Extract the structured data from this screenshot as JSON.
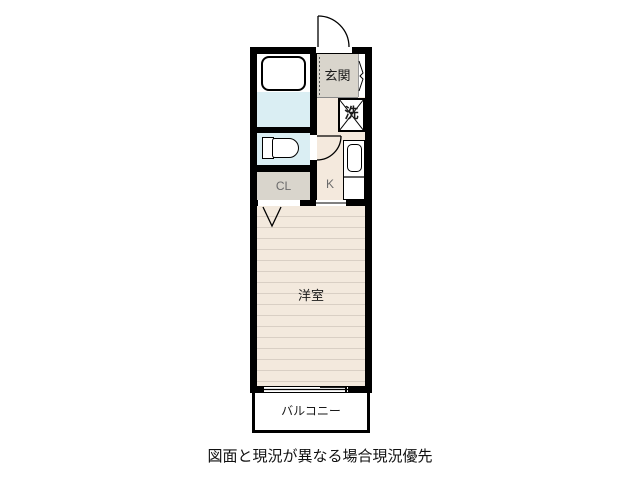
{
  "floorplan": {
    "rooms": {
      "genkan": {
        "label": "玄関"
      },
      "washer": {
        "label": "洗"
      },
      "closet": {
        "label": "CL"
      },
      "kitchen": {
        "label": "K"
      },
      "western_room": {
        "label": "洋室"
      },
      "balcony": {
        "label": "バルコニー"
      }
    },
    "caption": "図面と現況が異なる場合現況優先",
    "colors": {
      "wall": "#000000",
      "room_floor": "#f3e9dd",
      "floor_stripe": "#d9cfc4",
      "entry_floor": "#d9d5cc",
      "wet_area_floor": "#daeef3",
      "fixture_fill": "#ffffff",
      "dim_label": "#6b6b6b"
    }
  }
}
